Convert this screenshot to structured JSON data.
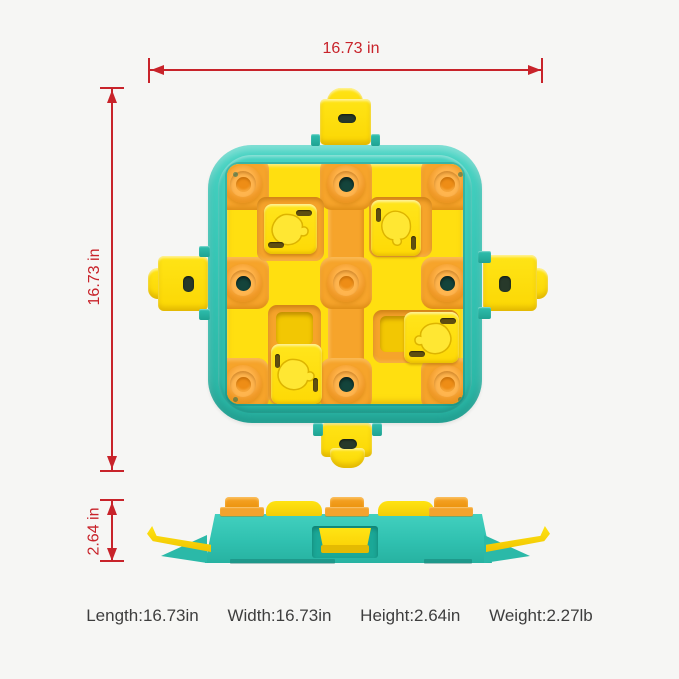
{
  "dimensions": {
    "width": {
      "label": "16.73 in"
    },
    "height": {
      "label": "16.73 in"
    },
    "depth": {
      "label": "2.64 in"
    }
  },
  "specs": [
    {
      "label": "Length:",
      "value": "16.73in"
    },
    {
      "label": "Width:",
      "value": "16.73in"
    },
    {
      "label": "Height:",
      "value": "2.64in"
    },
    {
      "label": "Weight:",
      "value": "2.27lb"
    }
  ],
  "icons": {
    "treat_shape": "drumstick-icon",
    "dimension_arrows": "double-arrow-icon"
  },
  "colors": {
    "background": "#f6f6f4",
    "red": "#c8232a",
    "teal": "#35c7b6",
    "teal-dark": "#1fa795",
    "yellow": "#ffdf10",
    "orange": "#f6a42b",
    "circle-dark": "#14443b",
    "slot": "#5f4e10",
    "text": "#3e3e3e"
  }
}
